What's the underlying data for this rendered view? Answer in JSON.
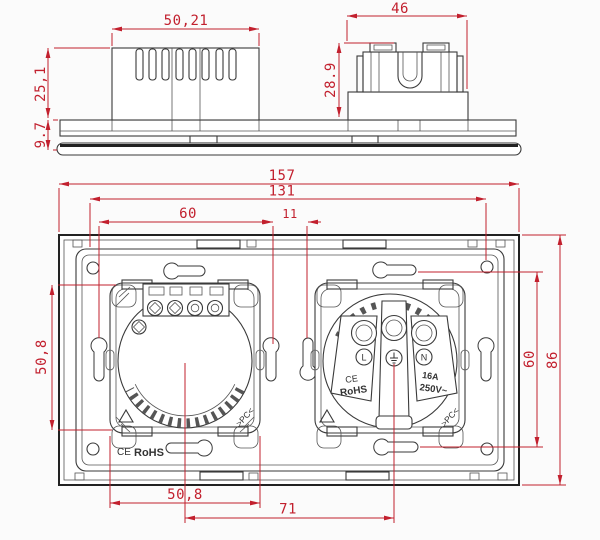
{
  "side_view": {
    "dims": {
      "switch_width": "50,21",
      "socket_width": "46",
      "switch_height": "25,1",
      "panel_thickness": "9.7",
      "socket_height": "28.9"
    }
  },
  "rear_view": {
    "dims": {
      "overall_width": "157",
      "plate_width": "131",
      "hole_pitch_horizontal": "60",
      "module_gap": "11",
      "switch_module_height": "50,8",
      "switch_module_width": "50,8",
      "module_center_pitch": "71",
      "hole_pitch_vertical": "60",
      "overall_height": "86"
    },
    "markings": {
      "plate_ce": "CE",
      "plate_rohs": "RoHS",
      "switch_material": ">PC<",
      "socket_material": ">PC<",
      "socket_ce": "CE",
      "socket_rohs": "RoHS",
      "socket_current": "16A",
      "socket_voltage": "250V~",
      "terminal_live": "L",
      "terminal_neutral": "N"
    }
  },
  "colors": {
    "dimension": "#c2202e",
    "line": "#2f2f2f",
    "background": "#fbfbfb"
  }
}
